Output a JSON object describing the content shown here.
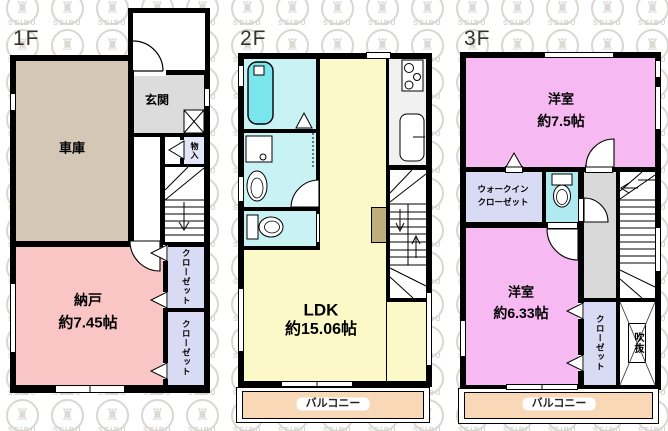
{
  "floors": {
    "f1": {
      "label": "1F",
      "garage": "車庫",
      "entrance": "玄関",
      "cabinet": "物入",
      "storage": "納戸",
      "storage_size": "約7.45帖",
      "closet_a": "クローゼット",
      "closet_b": "クローゼット"
    },
    "f2": {
      "label": "2F",
      "ldk": "LDK",
      "ldk_size": "約15.06帖",
      "balcony": "バルコニー"
    },
    "f3": {
      "label": "3F",
      "bedroom_a": "洋室",
      "bedroom_a_size": "約7.5帖",
      "wic_line1": "ウォークイン",
      "wic_line2": "クローゼット",
      "bedroom_b": "洋室",
      "bedroom_b_size": "約6.33帖",
      "closet": "クローゼット",
      "void": "吹抜",
      "balcony": "バルコニー"
    }
  },
  "watermark": {
    "brand": "SEIBU"
  },
  "colors": {
    "wall": "#000000",
    "garage": "#d4c7b5",
    "storage_room": "#f9c5c5",
    "bedroom_pink": "#f6b9f2",
    "ldk_yellow": "#fbf9c8",
    "bath_cyan": "#c9f2f4",
    "bathtub_cyan": "#7be5ee",
    "toilet_cyan": "#aeeaf0",
    "closet_lavender": "#d9dbf4",
    "balcony_peach": "#f8d8b6",
    "hallway_gray": "#d9d9d9",
    "entrance_gray": "#dcdcdc",
    "counter_khaki": "#bfae7c",
    "watermark_gray": "#d9d5d0"
  }
}
